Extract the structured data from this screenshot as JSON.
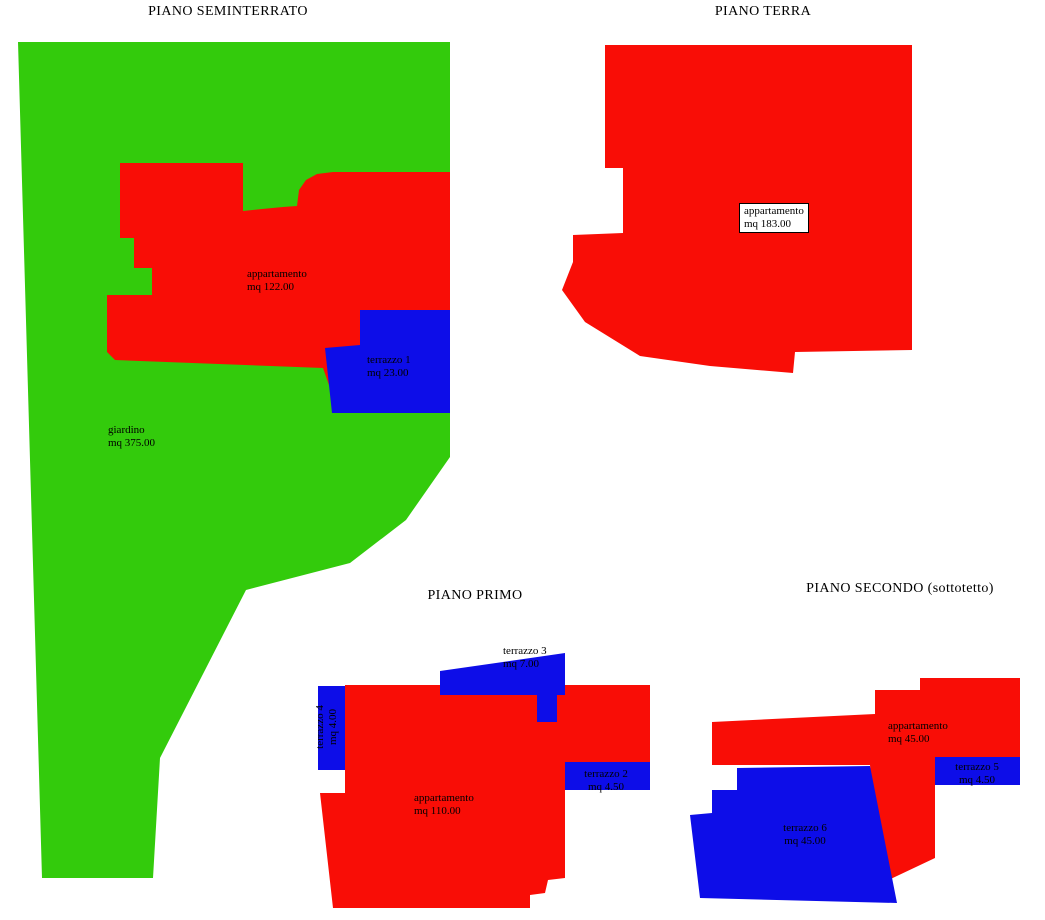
{
  "colors": {
    "garden": "#33CB0C",
    "apartment": "#F90D06",
    "terrace": "#0D0DE8",
    "text": "#000000",
    "background": "#FFFFFF"
  },
  "plans": {
    "seminterrato": {
      "title": "PIANO SEMINTERRATO",
      "garden": {
        "name": "giardino",
        "area": "mq 375.00"
      },
      "apartment": {
        "name": "appartamento",
        "area": "mq 122.00"
      },
      "terrace1": {
        "name": "terrazzo 1",
        "area": "mq 23.00"
      }
    },
    "terra": {
      "title": "PIANO TERRA",
      "apartment": {
        "name": "appartamento",
        "area": "mq 183.00"
      }
    },
    "primo": {
      "title": "PIANO PRIMO",
      "apartment": {
        "name": "appartamento",
        "area": "mq 110.00"
      },
      "terrace2": {
        "name": "terrazzo 2",
        "area": "mq 4.50"
      },
      "terrace3": {
        "name": "terrazzo 3",
        "area": "mq 7.00"
      },
      "terrace4": {
        "name": "terrazzo 4",
        "area": "mq 4.00"
      }
    },
    "secondo": {
      "title": "PIANO SECONDO (sottotetto)",
      "apartment": {
        "name": "appartamento",
        "area": "mq 45.00"
      },
      "terrace5": {
        "name": "terrazzo 5",
        "area": "mq 4.50"
      },
      "terrace6": {
        "name": "terrazzo 6",
        "area": "mq 45.00"
      }
    }
  }
}
